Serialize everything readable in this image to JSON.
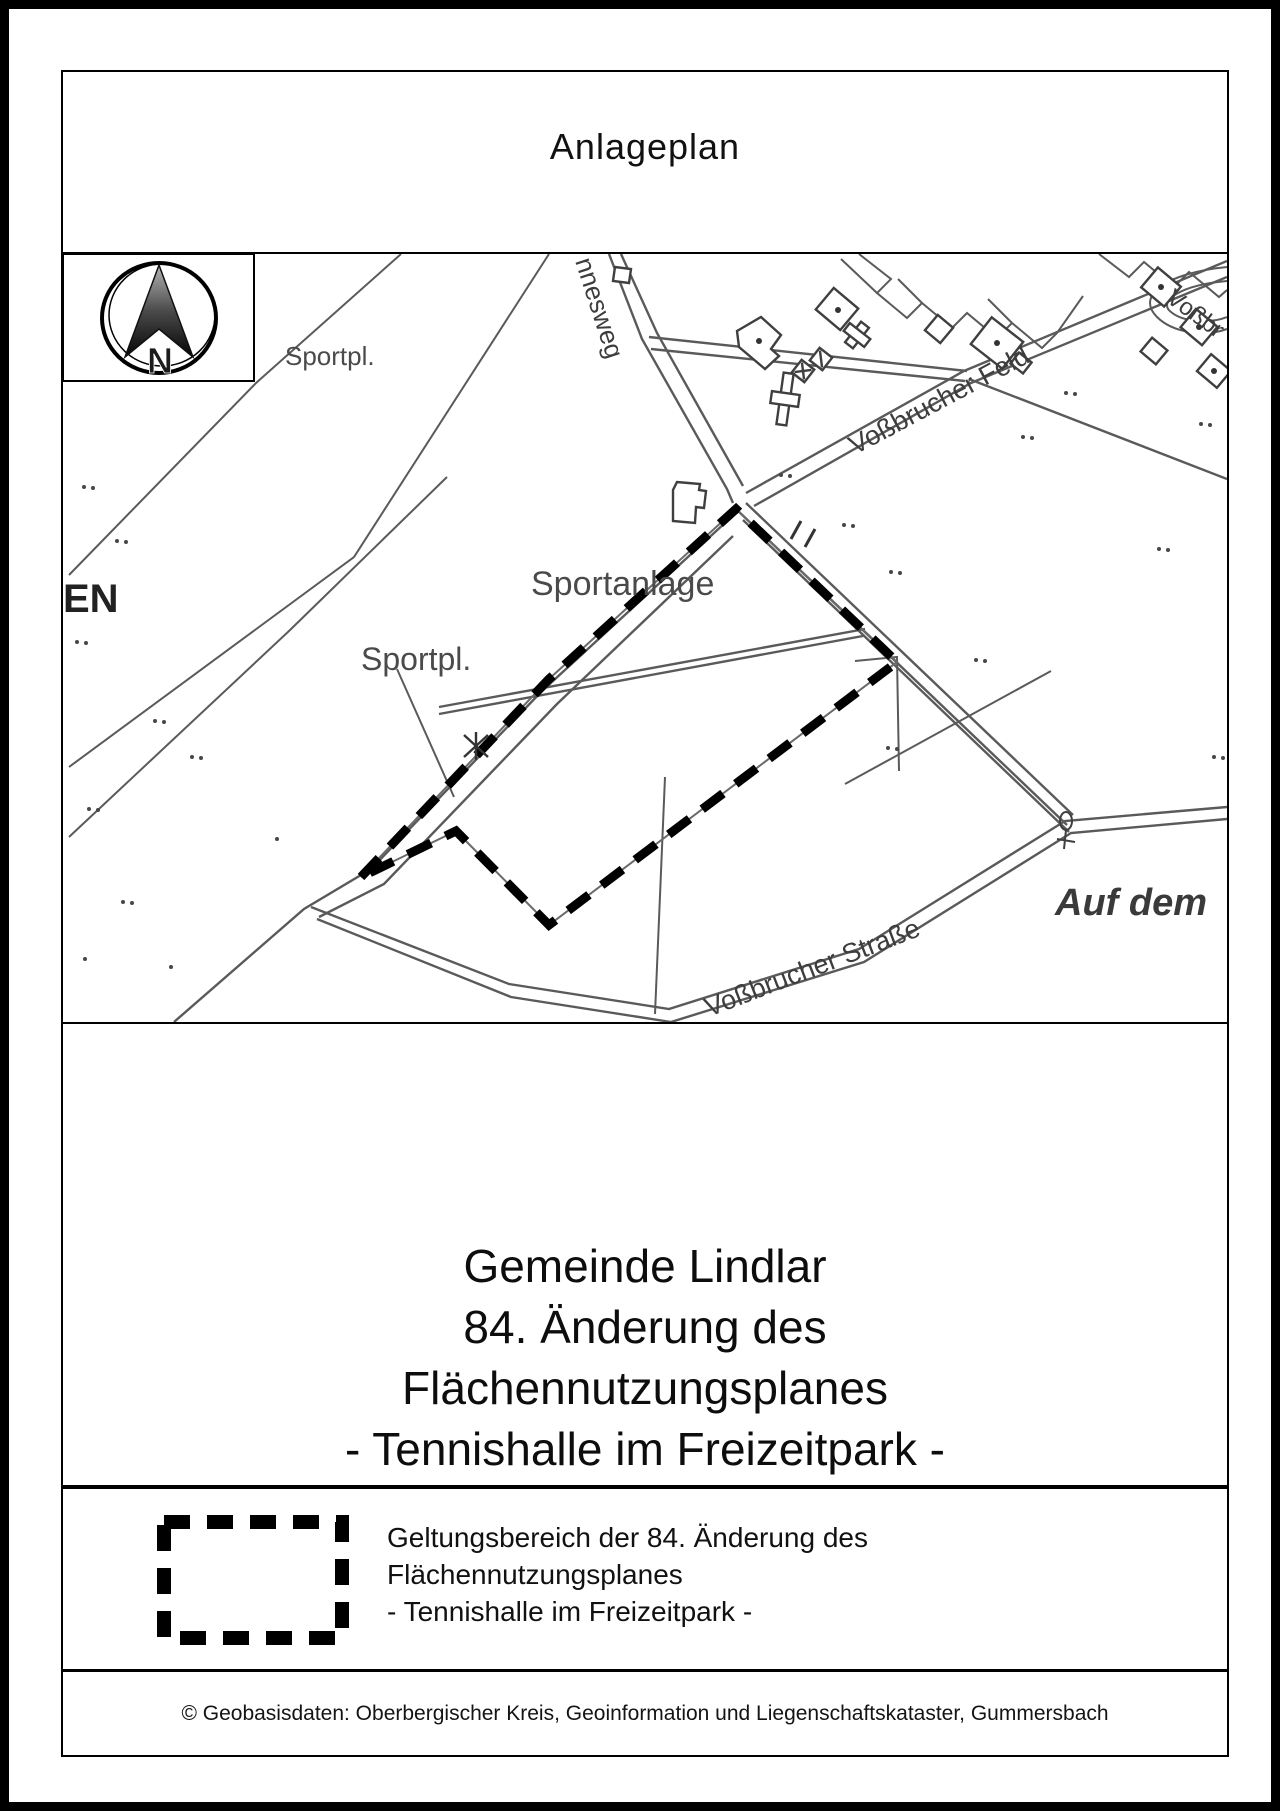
{
  "page": {
    "title": "Anlageplan"
  },
  "map": {
    "labels": {
      "sportplatz_top": "Sportpl.",
      "sportanlage": "Sportanlage",
      "sportplatz_lower": "Sportpl.",
      "street_feld": "Voßbrucher Feld",
      "street_strasse": "Voßbrucher Straße",
      "street_weg_partial": "nnesweg",
      "street_vossbr_partial": "Voßbr",
      "district_auf_dem": "Auf dem",
      "district_en_partial": "EN",
      "north_letter": "N"
    }
  },
  "title_block": {
    "line1": "Gemeinde Lindlar",
    "line2": "84. Änderung des",
    "line3": "Flächennutzungsplanes",
    "line4": "- Tennishalle im Freizeitpark -"
  },
  "legend": {
    "line1": "Geltungsbereich der 84. Änderung des",
    "line2": "Flächennutzungsplanes",
    "line3": "- Tennishalle im Freizeitpark -"
  },
  "footer": {
    "credit": "© Geobasisdaten: Oberbergischer Kreis, Geoinformation und Liegenschaftskataster, Gummersbach"
  },
  "colors": {
    "boundary": "#000000",
    "map_lines": "#5a5a5a",
    "building_outline": "#3f3f3f",
    "label_text": "#3d3d3d",
    "page_background": "#ffffff"
  }
}
